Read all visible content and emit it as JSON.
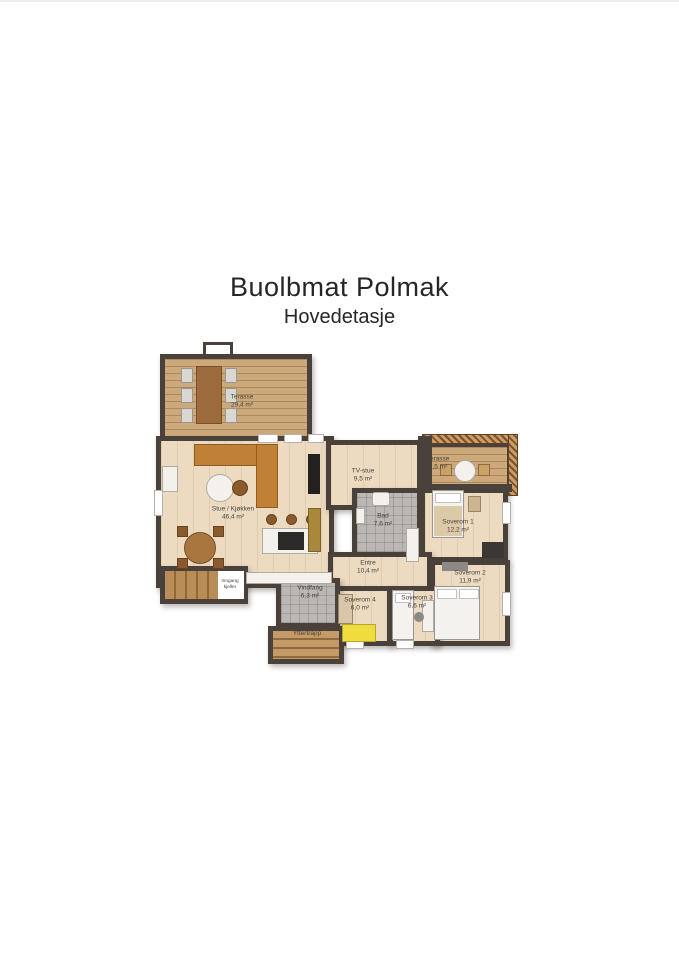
{
  "page": {
    "title": "Buolbmat Polmak",
    "subtitle": "Hovedetasje"
  },
  "rooms": {
    "terrace_large": {
      "name": "Terasse",
      "area": "29,4 m²"
    },
    "living_kitchen": {
      "name": "Stue / Kjøkken",
      "area": "46,4 m²"
    },
    "tv_room": {
      "name": "TV-stue",
      "area": "9,5 m²"
    },
    "bathroom": {
      "name": "Bad",
      "area": "7,6 m²"
    },
    "terrace_small": {
      "name": "Terasse",
      "area": "9,5 m²"
    },
    "bedroom_1": {
      "name": "Soverom 1",
      "area": "12,2 m²"
    },
    "bedroom_2": {
      "name": "Soverom 2",
      "area": "11,9 m²"
    },
    "entry_hall": {
      "name": "Entre",
      "area": "10,4 m²"
    },
    "bedroom_4": {
      "name": "Soverom 4",
      "area": "6,0 m²"
    },
    "bedroom_3": {
      "name": "Soverom 3",
      "area": "6,6 m²"
    },
    "vestibule": {
      "name": "Vindfang",
      "area": "6,3 m²"
    },
    "outer_stair": {
      "name": "Yttertrapp"
    },
    "basement_entry": {
      "line1": "Inngang",
      "line2": "kjeller"
    }
  },
  "colors": {
    "wall": "#49413a",
    "wood_floor": "#ecdbc0",
    "deck": "#cda87a",
    "tile": "#bab7b4",
    "sofa": "#c08136",
    "bed_yellow": "#efdc3e"
  }
}
